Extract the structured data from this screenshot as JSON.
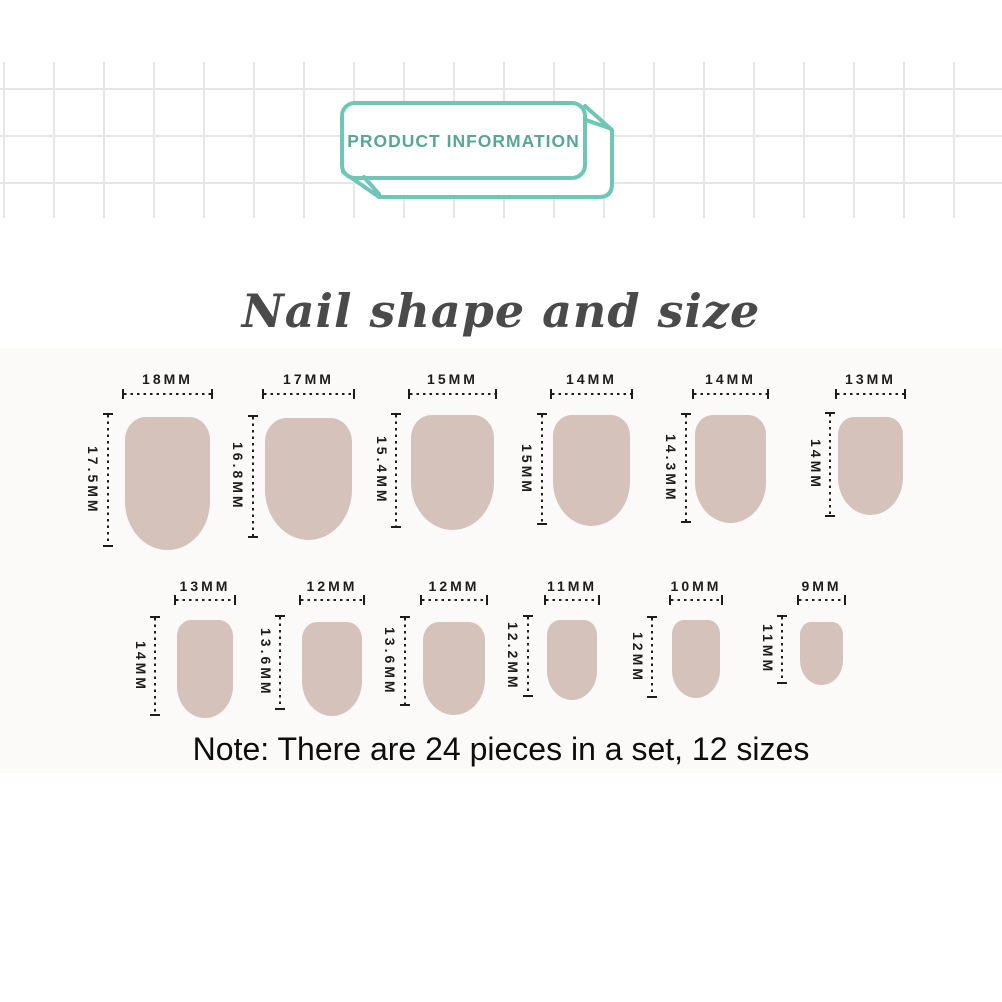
{
  "badge": {
    "label": "PRODUCT INFORMATION"
  },
  "section": {
    "title": "Nail shape and size",
    "note": "Note: There are 24 pieces in a set, 12 sizes"
  },
  "colors": {
    "accent": "#6ec6b7",
    "badge_text": "#58a795",
    "nail_fill": "#d5c2ba",
    "grid_line": "#e6e6e9",
    "dimension_ink": "#1c1c1c"
  },
  "chart_data": {
    "type": "table",
    "title": "Nail shape and size",
    "columns": [
      "nail_number",
      "width_mm",
      "height_mm"
    ],
    "rows": [
      [
        1,
        18,
        17.5
      ],
      [
        2,
        17,
        16.8
      ],
      [
        3,
        15,
        15.4
      ],
      [
        4,
        14,
        15.0
      ],
      [
        5,
        14,
        14.3
      ],
      [
        6,
        13,
        14.0
      ],
      [
        7,
        13,
        14.0
      ],
      [
        8,
        12,
        13.6
      ],
      [
        9,
        12,
        13.6
      ],
      [
        10,
        11,
        12.2
      ],
      [
        11,
        10,
        12.0
      ],
      [
        12,
        9,
        11.0
      ]
    ],
    "note": "24 pieces in a set, 12 sizes"
  },
  "diagram": {
    "rows": [
      {
        "wlabel_y": 371,
        "hline_y": 393,
        "items": [
          {
            "width_label": "18MM",
            "height_label": "17.5MM",
            "x": 125,
            "y": 417,
            "w": 85,
            "h": 133,
            "vx": 108,
            "vy1": 413,
            "vy2": 547,
            "vlx": 93
          },
          {
            "width_label": "17MM",
            "height_label": "16.8MM",
            "x": 265,
            "y": 418,
            "w": 87,
            "h": 122,
            "vx": 253,
            "vy1": 415,
            "vy2": 538,
            "vlx": 238
          },
          {
            "width_label": "15MM",
            "height_label": "15.4MM",
            "x": 411,
            "y": 415,
            "w": 83,
            "h": 115,
            "vx": 396,
            "vy1": 413,
            "vy2": 528,
            "vlx": 382
          },
          {
            "width_label": "14MM",
            "height_label": "15MM",
            "x": 553,
            "y": 415,
            "w": 77,
            "h": 111,
            "vx": 542,
            "vy1": 413,
            "vy2": 525,
            "vlx": 527
          },
          {
            "width_label": "14MM",
            "height_label": "14.3MM",
            "x": 695,
            "y": 415,
            "w": 71,
            "h": 108,
            "vx": 686,
            "vy1": 413,
            "vy2": 523,
            "vlx": 671
          },
          {
            "width_label": "13MM",
            "height_label": "14MM",
            "x": 838,
            "y": 417,
            "w": 65,
            "h": 98,
            "vx": 830,
            "vy1": 412,
            "vy2": 517,
            "vlx": 816
          }
        ]
      },
      {
        "wlabel_y": 578,
        "hline_y": 599,
        "items": [
          {
            "width_label": "13MM",
            "height_label": "14MM",
            "x": 177,
            "y": 620,
            "w": 56,
            "h": 98,
            "vx": 155,
            "vy1": 616,
            "vy2": 716,
            "vlx": 141
          },
          {
            "width_label": "12MM",
            "height_label": "13.6MM",
            "x": 302,
            "y": 622,
            "w": 60,
            "h": 94,
            "vx": 280,
            "vy1": 615,
            "vy2": 710,
            "vlx": 266
          },
          {
            "width_label": "12MM",
            "height_label": "13.6MM",
            "x": 423,
            "y": 622,
            "w": 62,
            "h": 93,
            "vx": 405,
            "vy1": 616,
            "vy2": 706,
            "vlx": 390
          },
          {
            "width_label": "11MM",
            "height_label": "12.2MM",
            "x": 547,
            "y": 620,
            "w": 50,
            "h": 80,
            "vx": 528,
            "vy1": 615,
            "vy2": 697,
            "vlx": 513
          },
          {
            "width_label": "10MM",
            "height_label": "12MM",
            "x": 672,
            "y": 620,
            "w": 48,
            "h": 78,
            "vx": 652,
            "vy1": 616,
            "vy2": 698,
            "vlx": 638
          },
          {
            "width_label": "9MM",
            "height_label": "11MM",
            "x": 800,
            "y": 622,
            "w": 43,
            "h": 63,
            "vx": 782,
            "vy1": 615,
            "vy2": 684,
            "vlx": 768
          }
        ]
      }
    ]
  }
}
